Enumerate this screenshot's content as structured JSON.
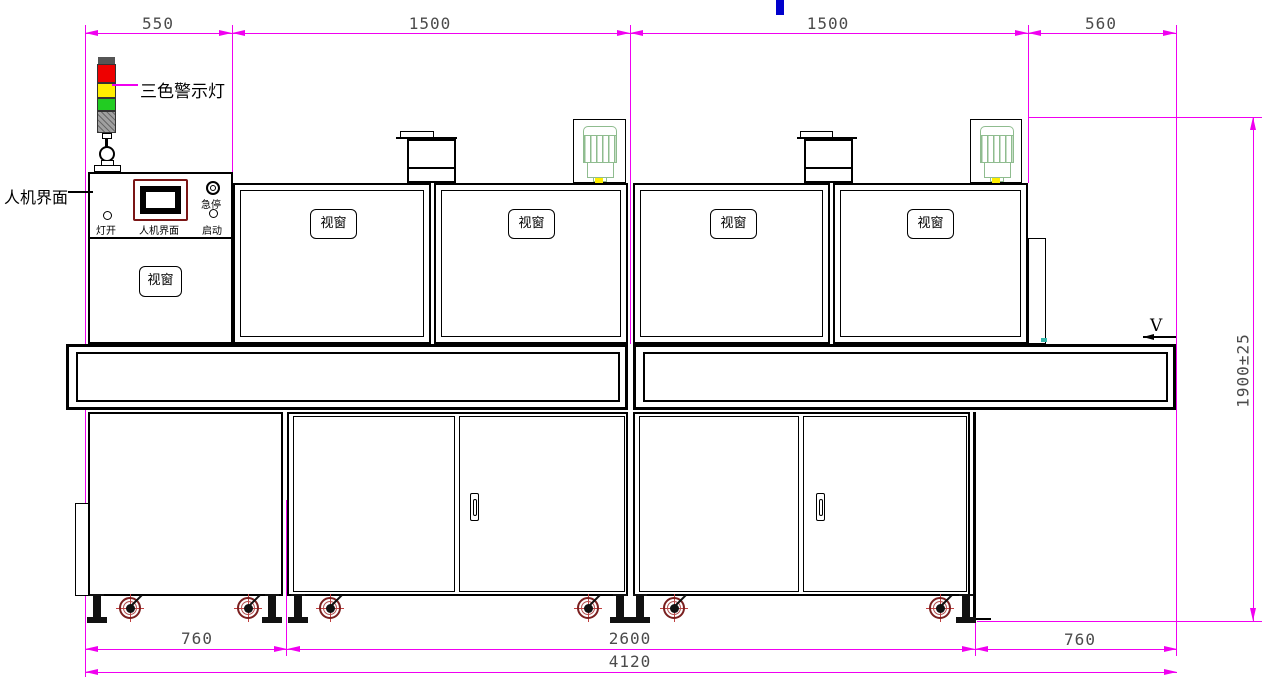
{
  "drawing": {
    "dims": {
      "top_550": "550",
      "top_1500a": "1500",
      "top_1500b": "1500",
      "top_560": "560",
      "height": "1900±25",
      "bottom_760l": "760",
      "bottom_2600": "2600",
      "bottom_760r": "760",
      "bottom_4120": "4120"
    },
    "callouts": {
      "tower_light": "三色警示灯",
      "hmi": "人机界面",
      "view_marker": "V"
    },
    "panel": {
      "light_on": "灯开",
      "hmi": "人机界面",
      "estop": "急停",
      "start": "启动"
    },
    "windows": {
      "head": "视窗",
      "t1": "视窗",
      "t2": "视窗",
      "t3": "视窗",
      "t4": "视窗"
    },
    "colors": {
      "dimension_line": "#f000f0",
      "outline": "#000000",
      "tower_red": "#ee0000",
      "tower_yellow": "#ffee00",
      "tower_green": "#22cc22",
      "tower_gray": "#a0a0a0",
      "motor_green": "#8fbc8f",
      "caster_red": "#7a1f1f",
      "marker_blue": "#0000cc"
    }
  }
}
